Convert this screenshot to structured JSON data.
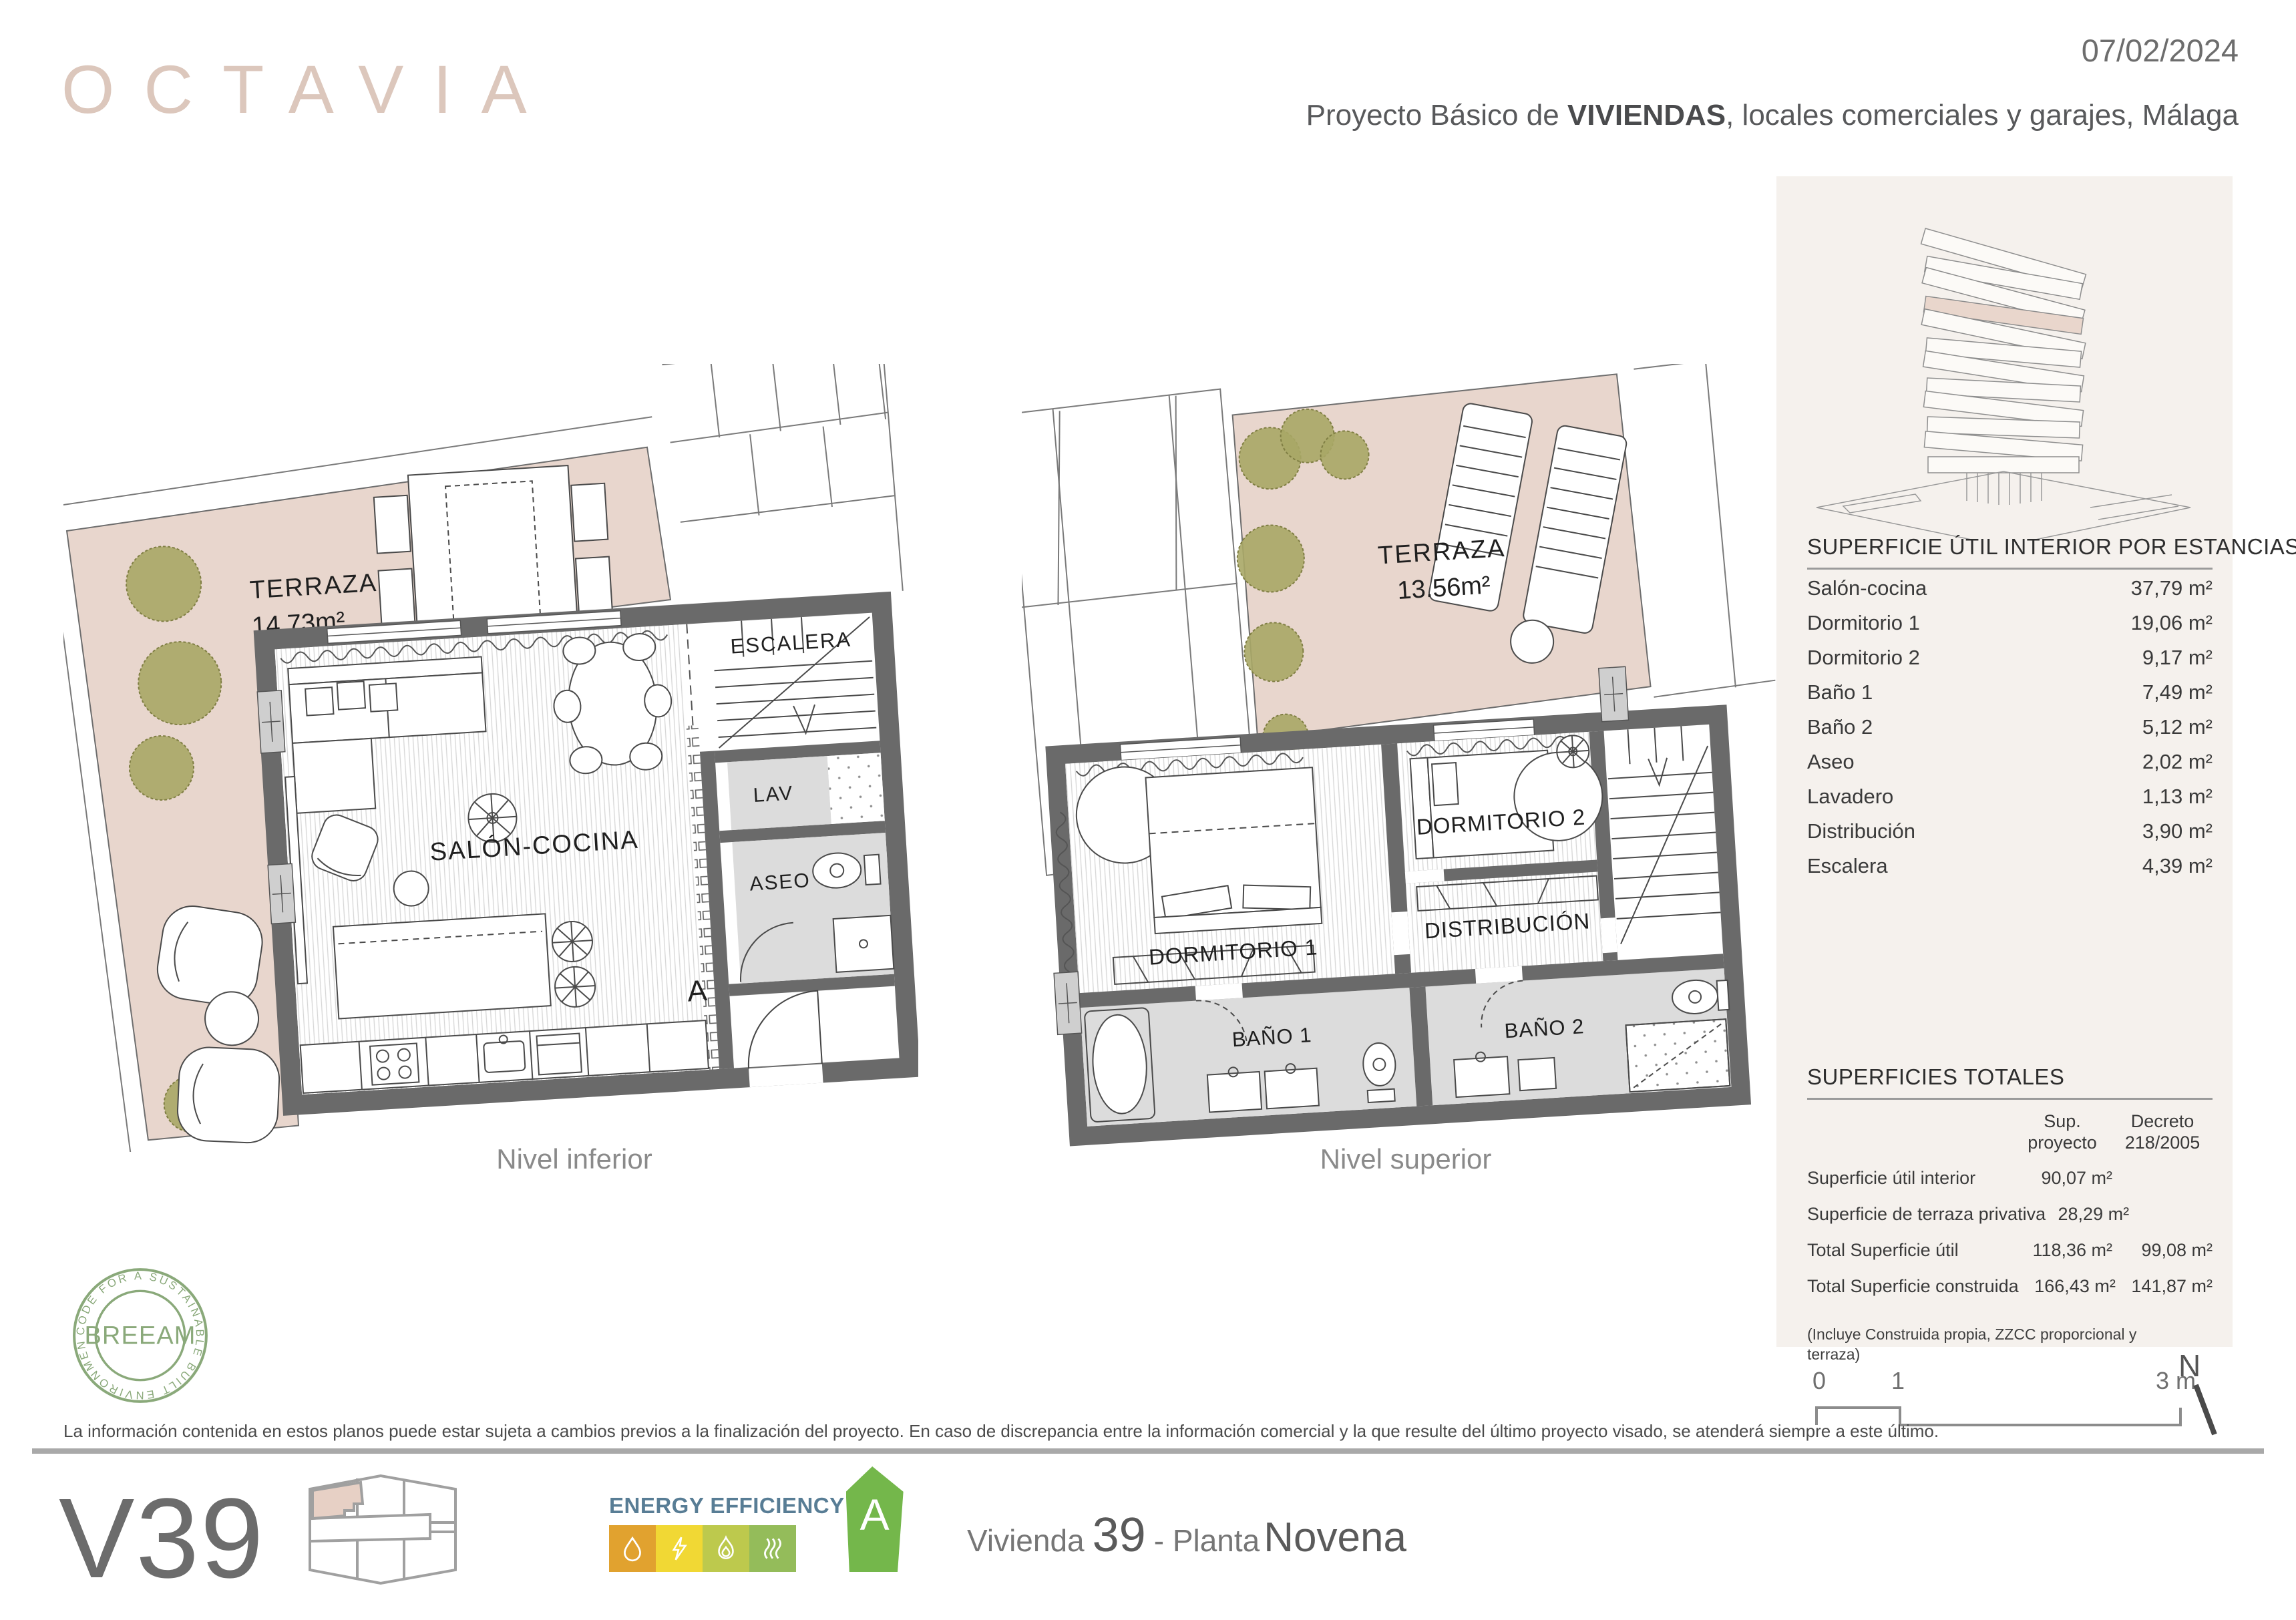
{
  "header": {
    "logo": "OCTAVIA",
    "date": "07/02/2024",
    "subtitle_pre": "Proyecto Básico de ",
    "subtitle_em": "VIVIENDAS",
    "subtitle_post": ", locales comerciales y garajes, Málaga"
  },
  "plan_inferior": {
    "caption": "Nivel inferior",
    "terrace_label": "TERRAZA",
    "terrace_area": "14.73m²",
    "room_salon": "SALÓN-COCINA",
    "room_escalera": "ESCALERA",
    "room_lav": "LAV",
    "room_aseo": "ASEO",
    "section_mark": "A"
  },
  "plan_superior": {
    "caption": "Nivel superior",
    "terrace_label": "TERRAZA",
    "terrace_area": "13.56m²",
    "room_dormitorio1": "DORMITORIO 1",
    "room_dormitorio2": "DORMITORIO 2",
    "room_distribucion": "DISTRIBUCIÓN",
    "room_bano1": "BAÑO 1",
    "room_bano2": "BAÑO 2"
  },
  "areas_table": {
    "title": "SUPERFICIE ÚTIL INTERIOR POR ESTANCIAS",
    "rows": [
      {
        "label": "Salón-cocina",
        "value": "37,79 m²"
      },
      {
        "label": "Dormitorio 1",
        "value": "19,06 m²"
      },
      {
        "label": "Dormitorio 2",
        "value": "9,17 m²"
      },
      {
        "label": "Baño 1",
        "value": "7,49 m²"
      },
      {
        "label": "Baño 2",
        "value": "5,12 m²"
      },
      {
        "label": "Aseo",
        "value": "2,02 m²"
      },
      {
        "label": "Lavadero",
        "value": "1,13 m²"
      },
      {
        "label": "Distribución",
        "value": "3,90 m²"
      },
      {
        "label": "Escalera",
        "value": "4,39 m²"
      }
    ]
  },
  "totals_table": {
    "title": "SUPERFICIES TOTALES",
    "col1": "Sup.\nproyecto",
    "col2": "Decreto\n218/2005",
    "rows": [
      {
        "label": "Superficie útil interior",
        "proyecto": "90,07 m²",
        "decreto": ""
      },
      {
        "label": "Superficie de terraza privativa",
        "proyecto": "28,29 m²",
        "decreto": ""
      },
      {
        "label": "Total Superficie útil",
        "proyecto": "118,36 m²",
        "decreto": "99,08 m²"
      },
      {
        "label": "Total Superficie construida",
        "proyecto": "166,43 m²",
        "decreto": "141,87 m²"
      }
    ],
    "footnote_line1": "(Incluye Construida propia, ZZCC proporcional y",
    "footnote_line2": "terraza)"
  },
  "scale_bar": {
    "tick0": "0",
    "tick1": "1",
    "tick3": "3 m",
    "north": "N"
  },
  "breeam": {
    "center": "BREEAM",
    "ring": "CODE FOR A SUSTAINABLE BUILT ENVIRONMENT"
  },
  "footer": {
    "disclaimer": "La información contenida en estos planos puede estar sujeta a cambios previos a la finalización del proyecto. En caso de discrepancia entre la información comercial y la que resulte del último proyecto visado, se atenderá siempre a este último.",
    "unit_code": "V39",
    "energy_title": "ENERGY EFFICIENCY",
    "energy_rating": "A",
    "dwelling_label": "Vivienda",
    "dwelling_number": "39",
    "floor_label": "- Planta",
    "floor_name": "Novena"
  },
  "colors": {
    "brand_pink": "#dcc7bc",
    "terrace_pink": "#e8d6cd",
    "panel_cream": "#f5f1ed",
    "wall_gray": "#6a6a6a",
    "breeam_green": "#8aa97a",
    "energy_arrow_green": "#74b74b",
    "energy_orange": "#e1a22f",
    "energy_yellow": "#f1d834",
    "energy_yellow_green": "#bdc94d",
    "energy_green": "#94bc5a",
    "energy_title_blue": "#587d95"
  }
}
